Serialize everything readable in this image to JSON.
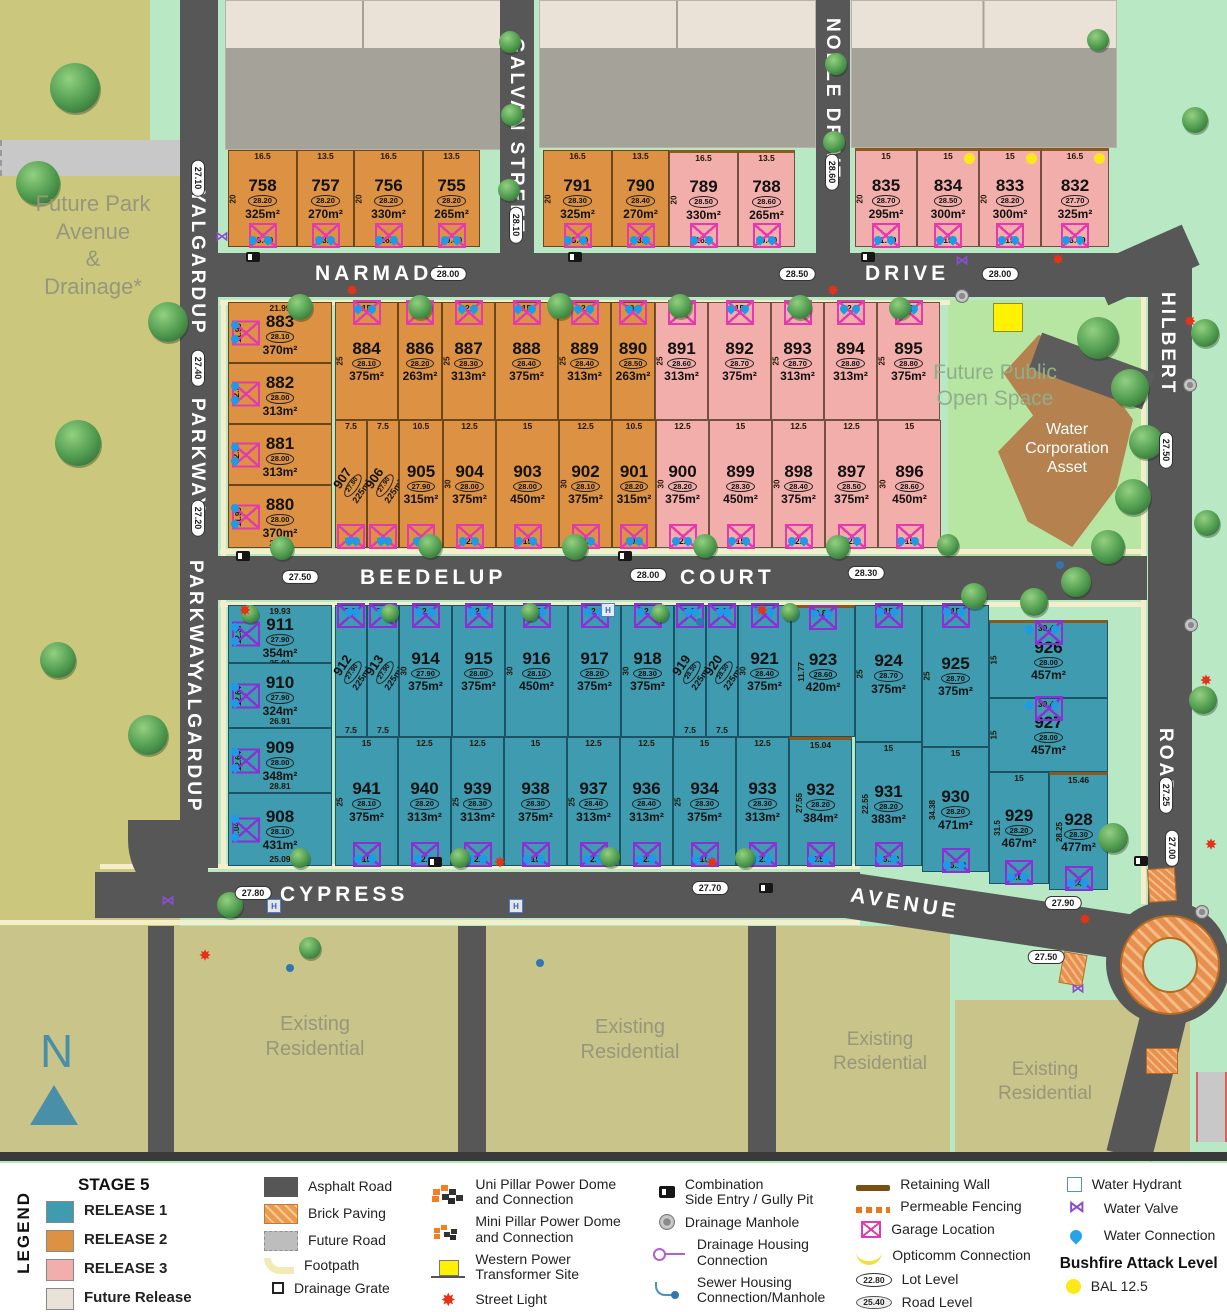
{
  "areas": {
    "future_park": "Future Park\nAvenue\n&\nDrainage*",
    "open_space": "Future Public\nOpen Space",
    "water_asset": "Water\nCorporation\nAsset",
    "existing": "Existing\nResidential",
    "compass": "N"
  },
  "roads": {
    "narmada": "NARMADA",
    "drive": "DRIVE",
    "galvan": "GALVAN STREET",
    "noble": "NOBLE DRIVE",
    "yalgardup": "YALGARDUP",
    "parkway": "PARKWAY",
    "hilbert": "HILBERT",
    "road": "ROAD",
    "beedelup": "BEEDELUP",
    "court": "COURT",
    "cypress": "CYPRESS",
    "avenue": "AVENUE"
  },
  "road_levels": [
    {
      "t": "28.10",
      "x": 516,
      "y": 225,
      "v": 1
    },
    {
      "t": "28.60",
      "x": 832,
      "y": 172,
      "v": 1
    },
    {
      "t": "28.00",
      "x": 448,
      "y": 274
    },
    {
      "t": "28.50",
      "x": 797,
      "y": 274
    },
    {
      "t": "28.00",
      "x": 1000,
      "y": 274
    },
    {
      "t": "27.10",
      "x": 198,
      "y": 178,
      "v": 1
    },
    {
      "t": "27.40",
      "x": 198,
      "y": 368,
      "v": 1
    },
    {
      "t": "27.20",
      "x": 198,
      "y": 518,
      "v": 1
    },
    {
      "t": "27.50",
      "x": 300,
      "y": 577
    },
    {
      "t": "28.00",
      "x": 648,
      "y": 575
    },
    {
      "t": "28.30",
      "x": 866,
      "y": 573
    },
    {
      "t": "27.50",
      "x": 1166,
      "y": 450,
      "v": 1
    },
    {
      "t": "27.25",
      "x": 1166,
      "y": 795,
      "v": 1
    },
    {
      "t": "27.80",
      "x": 253,
      "y": 893
    },
    {
      "t": "27.70",
      "x": 710,
      "y": 888
    },
    {
      "t": "27.90",
      "x": 1063,
      "y": 903
    },
    {
      "t": "27.00",
      "x": 1172,
      "y": 848,
      "v": 1
    },
    {
      "t": "27.50",
      "x": 1046,
      "y": 957
    }
  ],
  "lots": [
    {
      "n": "758",
      "a": "325m²",
      "lv": "28.20",
      "c": "r2",
      "x": 228,
      "y": 150,
      "w": 69,
      "h": 97,
      "d1": "16.5",
      "d2": "13.49",
      "dd": "20",
      "gp": "b"
    },
    {
      "n": "757",
      "a": "270m²",
      "lv": "28.20",
      "c": "r2",
      "x": 297,
      "y": 150,
      "w": 57,
      "h": 97,
      "d1": "13.5",
      "d2": "13.5",
      "gp": "b"
    },
    {
      "n": "756",
      "a": "330m²",
      "lv": "28.20",
      "c": "r2",
      "x": 354,
      "y": 150,
      "w": 69,
      "h": 97,
      "d1": "16.5",
      "d2": "16.5",
      "dd": "20",
      "gp": "b"
    },
    {
      "n": "755",
      "a": "265m²",
      "lv": "28.20",
      "c": "r2",
      "x": 423,
      "y": 150,
      "w": 57,
      "h": 97,
      "d1": "13.5",
      "d2": "10.49",
      "gp": "b"
    },
    {
      "n": "791",
      "a": "325m²",
      "lv": "28.30",
      "c": "r2",
      "x": 543,
      "y": 150,
      "w": 69,
      "h": 97,
      "d1": "16.5",
      "d2": "13.49",
      "dd": "20",
      "gp": "b"
    },
    {
      "n": "790",
      "a": "270m²",
      "lv": "28.40",
      "c": "r2",
      "x": 612,
      "y": 150,
      "w": 57,
      "h": 97,
      "d1": "13.5",
      "d2": "13.5",
      "gp": "b"
    },
    {
      "n": "789",
      "a": "330m²",
      "lv": "28.50",
      "c": "r3",
      "x": 669,
      "y": 150,
      "w": 69,
      "h": 97,
      "d1": "16.5",
      "d2": "16.5",
      "dd": "20",
      "rw": 1,
      "gp": "b"
    },
    {
      "n": "788",
      "a": "265m²",
      "lv": "28.60",
      "c": "r3",
      "x": 738,
      "y": 150,
      "w": 57,
      "h": 97,
      "d1": "13.5",
      "d2": "10.49",
      "rw": 1,
      "gp": "b"
    },
    {
      "n": "835",
      "a": "295m²",
      "lv": "28.70",
      "c": "r3",
      "x": 855,
      "y": 148,
      "w": 62,
      "h": 99,
      "d1": "15",
      "d2": "11.99",
      "dd": "20",
      "rw": 1,
      "gp": "b"
    },
    {
      "n": "834",
      "a": "300m²",
      "lv": "28.50",
      "c": "r3",
      "x": 917,
      "y": 148,
      "w": 62,
      "h": 99,
      "d1": "15",
      "d2": "15",
      "rw": 1,
      "bal": 1,
      "gp": "b"
    },
    {
      "n": "833",
      "a": "300m²",
      "lv": "28.20",
      "c": "r3",
      "x": 979,
      "y": 148,
      "w": 62,
      "h": 99,
      "d1": "15",
      "d2": "15",
      "dd": "20",
      "rw": 1,
      "bal": 1,
      "gp": "b"
    },
    {
      "n": "832",
      "a": "325m²",
      "lv": "27.70",
      "c": "r3",
      "x": 1041,
      "y": 148,
      "w": 68,
      "h": 99,
      "d1": "16.5",
      "d2": "13.49",
      "rw": 1,
      "bal": 1,
      "gp": "b"
    },
    {
      "n": "883",
      "a": "370m²",
      "lv": "28.10",
      "c": "r2",
      "x": 228,
      "y": 302,
      "w": 104,
      "h": 61,
      "d1": "21.99",
      "ds": "11.99",
      "gp": "l"
    },
    {
      "n": "882",
      "a": "313m²",
      "lv": "28.00",
      "c": "r2",
      "x": 228,
      "y": 363,
      "w": 104,
      "h": 61,
      "ds": "12.5",
      "gp": "l"
    },
    {
      "n": "881",
      "a": "313m²",
      "lv": "28.00",
      "c": "r2",
      "x": 228,
      "y": 424,
      "w": 104,
      "h": 61,
      "ds": "12.5",
      "gp": "l"
    },
    {
      "n": "880",
      "a": "370m²",
      "lv": "28.00",
      "c": "r2",
      "x": 228,
      "y": 485,
      "w": 104,
      "h": 63,
      "d2": "21.99",
      "ds": "11.99",
      "gp": "l"
    },
    {
      "n": "884",
      "a": "375m²",
      "lv": "28.10",
      "c": "r2",
      "x": 335,
      "y": 302,
      "w": 63,
      "h": 118,
      "d1": "15",
      "dd": "25",
      "gp": "t"
    },
    {
      "n": "886",
      "a": "263m²",
      "lv": "28.20",
      "c": "r2",
      "x": 398,
      "y": 302,
      "w": 44,
      "h": 118,
      "d1": "10.5",
      "gp": "t"
    },
    {
      "n": "887",
      "a": "313m²",
      "lv": "28.30",
      "c": "r2",
      "x": 442,
      "y": 302,
      "w": 53,
      "h": 118,
      "d1": "12.5",
      "dd": "25",
      "gp": "t"
    },
    {
      "n": "888",
      "a": "375m²",
      "lv": "28.40",
      "c": "r2",
      "x": 495,
      "y": 302,
      "w": 63,
      "h": 118,
      "d1": "15",
      "gp": "t"
    },
    {
      "n": "889",
      "a": "313m²",
      "lv": "28.40",
      "c": "r2",
      "x": 558,
      "y": 302,
      "w": 53,
      "h": 118,
      "d1": "12.5",
      "dd": "25",
      "gp": "t"
    },
    {
      "n": "890",
      "a": "263m²",
      "lv": "28.50",
      "c": "r2",
      "x": 611,
      "y": 302,
      "w": 44,
      "h": 118,
      "d1": "10.5",
      "gp": "t"
    },
    {
      "n": "891",
      "a": "313m²",
      "lv": "28.60",
      "c": "r3",
      "x": 655,
      "y": 302,
      "w": 53,
      "h": 118,
      "d1": "12.5",
      "dd": "25",
      "gp": "t"
    },
    {
      "n": "892",
      "a": "375m²",
      "lv": "28.70",
      "c": "r3",
      "x": 708,
      "y": 302,
      "w": 63,
      "h": 118,
      "d1": "15",
      "gp": "t"
    },
    {
      "n": "893",
      "a": "313m²",
      "lv": "28.70",
      "c": "r3",
      "x": 771,
      "y": 302,
      "w": 53,
      "h": 118,
      "d1": "12.5",
      "dd": "25",
      "gp": "t"
    },
    {
      "n": "894",
      "a": "313m²",
      "lv": "28.80",
      "c": "r3",
      "x": 824,
      "y": 302,
      "w": 53,
      "h": 118,
      "d1": "12.5",
      "gp": "t"
    },
    {
      "n": "895",
      "a": "375m²",
      "lv": "28.80",
      "c": "r3",
      "x": 877,
      "y": 302,
      "w": 63,
      "h": 118,
      "d1": "15",
      "dd": "25",
      "gp": "t"
    },
    {
      "n": "907",
      "a": "225m²",
      "lv": "27.80",
      "c": "r2",
      "x": 335,
      "y": 420,
      "w": 32,
      "h": 128,
      "d1": "7.5",
      "d2": "7.5",
      "rot": 1,
      "gp": "b"
    },
    {
      "n": "906",
      "a": "225m²",
      "lv": "27.90",
      "c": "r2",
      "x": 367,
      "y": 420,
      "w": 32,
      "h": 128,
      "d1": "7.5",
      "d2": "7.5",
      "rot": 1,
      "gp": "b"
    },
    {
      "n": "905",
      "a": "315m²",
      "lv": "27.90",
      "c": "r2",
      "x": 399,
      "y": 420,
      "w": 44,
      "h": 128,
      "d1": "10.5",
      "d2": "10.5",
      "gp": "b"
    },
    {
      "n": "904",
      "a": "375m²",
      "lv": "28.00",
      "c": "r2",
      "x": 443,
      "y": 420,
      "w": 53,
      "h": 128,
      "d1": "12.5",
      "d2": "12.5",
      "dd": "30",
      "gp": "b"
    },
    {
      "n": "903",
      "a": "450m²",
      "lv": "28.00",
      "c": "r2",
      "x": 496,
      "y": 420,
      "w": 63,
      "h": 128,
      "d1": "15",
      "d2": "15",
      "gp": "b"
    },
    {
      "n": "902",
      "a": "375m²",
      "lv": "28.10",
      "c": "r2",
      "x": 559,
      "y": 420,
      "w": 53,
      "h": 128,
      "d1": "12.5",
      "d2": "12.5",
      "dd": "30",
      "gp": "b"
    },
    {
      "n": "901",
      "a": "315m²",
      "lv": "28.20",
      "c": "r2",
      "x": 612,
      "y": 420,
      "w": 44,
      "h": 128,
      "d1": "10.5",
      "d2": "10.5",
      "gp": "b"
    },
    {
      "n": "900",
      "a": "375m²",
      "lv": "28.20",
      "c": "r3",
      "x": 656,
      "y": 420,
      "w": 53,
      "h": 128,
      "d1": "12.5",
      "d2": "12.5",
      "dd": "30",
      "gp": "b"
    },
    {
      "n": "899",
      "a": "450m²",
      "lv": "28.30",
      "c": "r3",
      "x": 709,
      "y": 420,
      "w": 63,
      "h": 128,
      "d1": "15",
      "d2": "15",
      "gp": "b"
    },
    {
      "n": "898",
      "a": "375m²",
      "lv": "28.40",
      "c": "r3",
      "x": 772,
      "y": 420,
      "w": 53,
      "h": 128,
      "d1": "12.5",
      "d2": "12.5",
      "dd": "30",
      "gp": "b"
    },
    {
      "n": "897",
      "a": "375m²",
      "lv": "28.50",
      "c": "r3",
      "x": 825,
      "y": 420,
      "w": 53,
      "h": 128,
      "d1": "12.5",
      "d2": "12.5",
      "gp": "b"
    },
    {
      "n": "896",
      "a": "450m²",
      "lv": "28.60",
      "c": "r3",
      "x": 878,
      "y": 420,
      "w": 63,
      "h": 128,
      "d1": "15",
      "d2": "15",
      "dd": "30",
      "gp": "b"
    },
    {
      "n": "911",
      "a": "354m²",
      "lv": "27.90",
      "c": "r1",
      "x": 228,
      "y": 605,
      "w": 104,
      "h": 58,
      "d1": "19.93",
      "d2": "25.01",
      "ds": "12.37",
      "gp": "l"
    },
    {
      "n": "910",
      "a": "324m²",
      "lv": "27.90",
      "c": "r1",
      "x": 228,
      "y": 663,
      "w": 104,
      "h": 65,
      "d2": "26.91",
      "ds": "12.64",
      "gp": "l"
    },
    {
      "n": "909",
      "a": "348m²",
      "lv": "28.00",
      "c": "r1",
      "x": 228,
      "y": 728,
      "w": 104,
      "h": 65,
      "d2": "28.81",
      "ds": "12.64",
      "gp": "l"
    },
    {
      "n": "908",
      "a": "431m²",
      "lv": "28.10",
      "c": "r1",
      "x": 228,
      "y": 793,
      "w": 104,
      "h": 73,
      "d2": "25.09",
      "ds": "9.04",
      "gp": "l"
    },
    {
      "n": "912",
      "a": "225m²",
      "lv": "27.90",
      "c": "r1",
      "x": 335,
      "y": 605,
      "w": 32,
      "h": 132,
      "d1": "7.5",
      "d2": "7.5",
      "rot": 1,
      "gp": "t"
    },
    {
      "n": "913",
      "a": "225m²",
      "lv": "27.90",
      "c": "r1",
      "x": 367,
      "y": 605,
      "w": 32,
      "h": 132,
      "d1": "7.5",
      "d2": "7.5",
      "rot": 1,
      "gp": "t"
    },
    {
      "n": "914",
      "a": "375m²",
      "lv": "27.90",
      "c": "r1",
      "x": 399,
      "y": 605,
      "w": 53,
      "h": 132,
      "d1": "12.5",
      "dd": "30",
      "gp": "t"
    },
    {
      "n": "915",
      "a": "375m²",
      "lv": "28.00",
      "c": "r1",
      "x": 452,
      "y": 605,
      "w": 53,
      "h": 132,
      "d1": "12.5",
      "gp": "t"
    },
    {
      "n": "916",
      "a": "450m²",
      "lv": "28.10",
      "c": "r1",
      "x": 505,
      "y": 605,
      "w": 63,
      "h": 132,
      "d1": "15",
      "dd": "30",
      "gp": "t"
    },
    {
      "n": "917",
      "a": "375m²",
      "lv": "28.20",
      "c": "r1",
      "x": 568,
      "y": 605,
      "w": 53,
      "h": 132,
      "d1": "12.5",
      "gp": "t"
    },
    {
      "n": "918",
      "a": "375m²",
      "lv": "28.30",
      "c": "r1",
      "x": 621,
      "y": 605,
      "w": 53,
      "h": 132,
      "d1": "12.5",
      "dd": "30",
      "gp": "t"
    },
    {
      "n": "919",
      "a": "225m²",
      "lv": "28.30",
      "c": "r1",
      "x": 674,
      "y": 605,
      "w": 32,
      "h": 132,
      "d1": "7.5",
      "d2": "7.5",
      "rot": 1,
      "gp": "t"
    },
    {
      "n": "920",
      "a": "225m²",
      "lv": "28.30",
      "c": "r1",
      "x": 706,
      "y": 605,
      "w": 32,
      "h": 132,
      "d1": "7.5",
      "d2": "7.5",
      "rot": 1,
      "gp": "t"
    },
    {
      "n": "921",
      "a": "375m²",
      "lv": "28.40",
      "c": "r1",
      "x": 738,
      "y": 605,
      "w": 53,
      "h": 132,
      "d1": "12.5",
      "dd": "30",
      "gp": "t"
    },
    {
      "n": "923",
      "a": "420m²",
      "lv": "28.60",
      "c": "r1",
      "x": 791,
      "y": 605,
      "w": 64,
      "h": 132,
      "d1": "8.84",
      "ds": "11.77",
      "rw": 1,
      "gp": "t"
    },
    {
      "n": "941",
      "a": "375m²",
      "lv": "28.10",
      "c": "r1",
      "x": 335,
      "y": 737,
      "w": 63,
      "h": 129,
      "d1": "15",
      "d2": "15",
      "dd": "25",
      "gp": "b"
    },
    {
      "n": "940",
      "a": "313m²",
      "lv": "28.20",
      "c": "r1",
      "x": 398,
      "y": 737,
      "w": 53,
      "h": 129,
      "d1": "12.5",
      "d2": "12.5",
      "gp": "b"
    },
    {
      "n": "939",
      "a": "313m²",
      "lv": "28.30",
      "c": "r1",
      "x": 451,
      "y": 737,
      "w": 53,
      "h": 129,
      "d1": "12.5",
      "d2": "12.5",
      "dd": "25",
      "gp": "b"
    },
    {
      "n": "938",
      "a": "375m²",
      "lv": "28.30",
      "c": "r1",
      "x": 504,
      "y": 737,
      "w": 63,
      "h": 129,
      "d1": "15",
      "d2": "15",
      "gp": "b"
    },
    {
      "n": "937",
      "a": "313m²",
      "lv": "28.40",
      "c": "r1",
      "x": 567,
      "y": 737,
      "w": 53,
      "h": 129,
      "d1": "12.5",
      "d2": "12.5",
      "dd": "25",
      "gp": "b"
    },
    {
      "n": "936",
      "a": "313m²",
      "lv": "28.40",
      "c": "r1",
      "x": 620,
      "y": 737,
      "w": 53,
      "h": 129,
      "d1": "12.5",
      "d2": "12.5",
      "gp": "b"
    },
    {
      "n": "934",
      "a": "375m²",
      "lv": "28.30",
      "c": "r1",
      "x": 673,
      "y": 737,
      "w": 63,
      "h": 129,
      "d1": "15",
      "d2": "15",
      "dd": "25",
      "gp": "b"
    },
    {
      "n": "933",
      "a": "313m²",
      "lv": "28.30",
      "c": "r1",
      "x": 736,
      "y": 737,
      "w": 53,
      "h": 129,
      "d1": "12.5",
      "d2": "12.5",
      "gp": "b"
    },
    {
      "n": "932",
      "a": "384m²",
      "lv": "28.20",
      "c": "r1",
      "x": 789,
      "y": 737,
      "w": 63,
      "h": 129,
      "d1": "15.04",
      "d2": "8.58",
      "ds": "27.55",
      "rw": 1,
      "gp": "b"
    },
    {
      "n": "924",
      "a": "375m²",
      "lv": "28.70",
      "c": "r1",
      "x": 855,
      "y": 605,
      "w": 67,
      "h": 137,
      "d1": "15",
      "dd": "25",
      "gp": "t"
    },
    {
      "n": "925",
      "a": "375m²",
      "lv": "28.70",
      "c": "r1",
      "x": 922,
      "y": 605,
      "w": 67,
      "h": 142,
      "d1": "15",
      "dd": "25",
      "gp": "t"
    },
    {
      "n": "926",
      "a": "457m²",
      "lv": "28.00",
      "c": "r1",
      "x": 989,
      "y": 620,
      "w": 119,
      "h": 78,
      "d1": "30.46",
      "ds": "15",
      "rw": 1,
      "gp": "t"
    },
    {
      "n": "927",
      "a": "457m²",
      "lv": "28.00",
      "c": "r1",
      "x": 989,
      "y": 698,
      "w": 119,
      "h": 74,
      "d1": "30.46",
      "ds": "15",
      "gp": "t"
    },
    {
      "n": "931",
      "a": "383m²",
      "lv": "28.20",
      "c": "r1",
      "x": 855,
      "y": 742,
      "w": 67,
      "h": 124,
      "d1": "15",
      "d2": "16.12",
      "ds": "22.55",
      "gp": "b"
    },
    {
      "n": "930",
      "a": "471m²",
      "lv": "28.20",
      "c": "r1",
      "x": 922,
      "y": 747,
      "w": 67,
      "h": 125,
      "d1": "15",
      "d2": "16.12",
      "ds": "34.38",
      "gp": "b"
    },
    {
      "n": "929",
      "a": "467m²",
      "lv": "28.20",
      "c": "r1",
      "x": 989,
      "y": 772,
      "w": 60,
      "h": 112,
      "d1": "15",
      "d2": "9.61",
      "ds": "31.5",
      "gp": "b"
    },
    {
      "n": "928",
      "a": "477m²",
      "lv": "28.30",
      "c": "r1",
      "x": 1049,
      "y": 772,
      "w": 59,
      "h": 118,
      "d1": "15.46",
      "d2": "9.45",
      "ds": "28.25",
      "rw": 1,
      "gp": "b"
    }
  ],
  "legend": {
    "side_label": "LEGEND",
    "stage": {
      "title": "STAGE 5",
      "items": [
        {
          "label": "RELEASE 1",
          "color": "#3E9BB0"
        },
        {
          "label": "RELEASE 2",
          "color": "#DD9243"
        },
        {
          "label": "RELEASE 3",
          "color": "#F2AEAB"
        },
        {
          "label": "Future Release",
          "color": "#EAE2D6"
        },
        {
          "label": "Existing Residential",
          "color": "#C9C489"
        }
      ]
    },
    "columns": [
      [
        {
          "icon": "asphalt",
          "label": "Asphalt Road"
        },
        {
          "icon": "brick",
          "label": "Brick Paving"
        },
        {
          "icon": "futureroad",
          "label": "Future Road"
        },
        {
          "icon": "footpath",
          "label": "Footpath"
        },
        {
          "icon": "grate",
          "label": "Drainage Grate"
        }
      ],
      [
        {
          "icon": "unipillar",
          "label": "Uni Pillar Power Dome\nand Connection"
        },
        {
          "icon": "minipillar",
          "label": "Mini Pillar Power Dome\nand Connection"
        },
        {
          "icon": "transformer",
          "label": "Western Power\nTransformer Site"
        },
        {
          "icon": "streetlight",
          "label": "Street Light"
        }
      ],
      [
        {
          "icon": "gully",
          "label": "Combination\nSide Entry / Gully Pit"
        },
        {
          "icon": "manhole",
          "label": "Drainage Manhole"
        },
        {
          "icon": "drainhouse",
          "label": "Drainage Housing\nConnection"
        },
        {
          "icon": "sewer",
          "label": "Sewer Housing\nConnection/Manhole"
        }
      ],
      [
        {
          "icon": "retaining",
          "label": "Retaining Wall"
        },
        {
          "icon": "fencing",
          "label": "Permeable Fencing"
        },
        {
          "icon": "garage",
          "label": "Garage Location"
        },
        {
          "icon": "opticomm",
          "label": "Opticomm Connection"
        },
        {
          "icon": "lotlevel",
          "label": "Lot Level",
          "value": "22.80"
        },
        {
          "icon": "roadlevel",
          "label": "Road Level",
          "value": "25.40"
        }
      ],
      [
        {
          "icon": "hydrant",
          "label": "Water Hydrant"
        },
        {
          "icon": "valve",
          "label": "Water Valve"
        },
        {
          "icon": "water",
          "label": "Water Connection"
        },
        {
          "header": "Bushfire Attack Level"
        },
        {
          "icon": "bal",
          "label": "BAL 12.5"
        }
      ]
    ]
  }
}
